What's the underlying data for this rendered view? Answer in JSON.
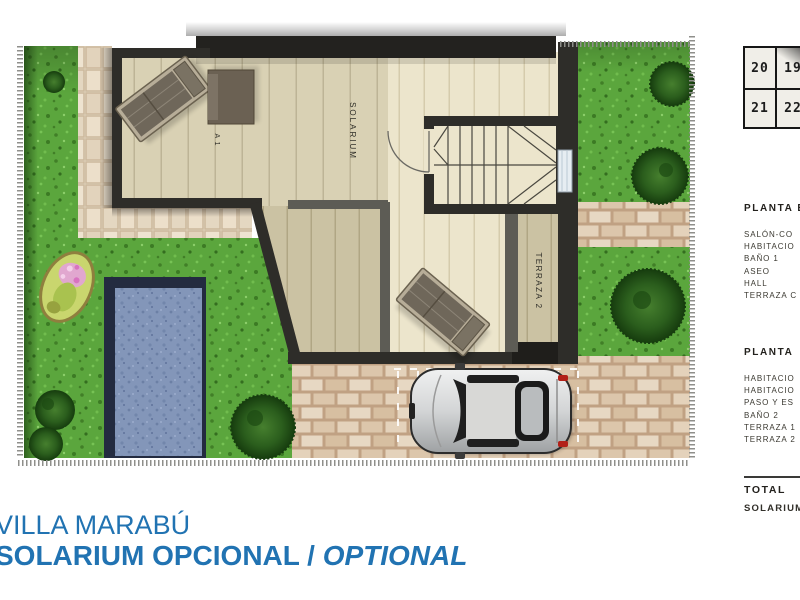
{
  "site_key": {
    "rows": [
      [
        "20",
        "19"
      ],
      [
        "21",
        "22",
        "2"
      ]
    ]
  },
  "sidebar": {
    "planta_baja": {
      "heading": "PLANTA B",
      "items": [
        "SALÓN-CO",
        "HABITACIO",
        "BAÑO 1",
        "ASEO",
        "HALL",
        "TERRAZA C"
      ]
    },
    "planta_primera": {
      "heading": "PLANTA",
      "items": [
        "HABITACIO",
        "HABITACIO",
        "PASO Y ES",
        "BAÑO 2",
        "TERRAZA 1",
        "TERRAZA 2"
      ]
    },
    "total": {
      "heading": "TOTAL",
      "item": "SOLARIUM"
    }
  },
  "plan_labels": {
    "solarium": "SOLARIUM",
    "terraza_2": "TERRAZA 2",
    "terraza_1_partial": "A 1"
  },
  "footer": {
    "title": "VILLA MARABÚ",
    "subtitle": "SOLARIUM OPCIONAL / ",
    "subtitle_italic": "OPTIONAL"
  },
  "colors": {
    "accent_blue": "#2173b2",
    "wall_dark": "#2e2d29",
    "grass_green": "#5ba63d",
    "pool_water": "#8396b9",
    "floor_cream": "#ece5cc"
  }
}
